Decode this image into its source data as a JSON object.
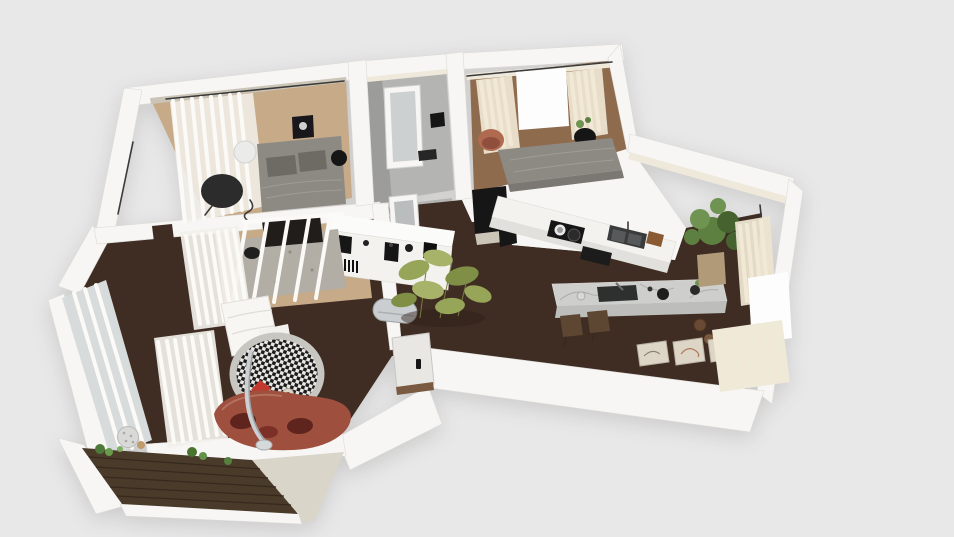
{
  "meta": {
    "description": "3D rendered apartment floor plan viewed from above in perspective, interior design render on a plain light gray backdrop",
    "view": "top-down 3d dollhouse",
    "visible_text": "none"
  },
  "palette": {
    "bg": "#e8e8e9",
    "wallWhite": "#f7f6f4",
    "wallShade": "#e3e1dd",
    "wallCream": "#efe9dc",
    "wallTaupe": "#cbc5b8",
    "floorDark": "#3f2d23",
    "woodLight": "#c7aa87",
    "woodMid": "#8f6b4e",
    "floorGray": "#b4b4b2",
    "floorGrayDark": "#9c9c9a",
    "balconyWood": "#4a3a2a",
    "balconyLine": "#35291d",
    "glassGray": "#d8dbdc",
    "curtainWhite": "#fbfaf7",
    "curtainCream": "#f1e9d6",
    "curtainBaseW": "#f2f0ea",
    "curtainBaseC": "#ece4d0",
    "bedGray": "#8d8a84",
    "pillowGray": "#6e6a64",
    "sofaRust": "#9e4f3e",
    "sofaPillow": "#5e241d",
    "redPillow": "#c2392e",
    "rugBorder": "#c8c6c1",
    "rugBlack": "#1c1c1c",
    "rugWhite": "#e9e8e4",
    "areaRugGray": "#b2ada5",
    "marble": "#cecfcd",
    "marbleShade": "#bdbdbb",
    "marbleVein": "#a5a6a4",
    "counterWhite": "#f3f2ef",
    "counterShade": "#e2e0dc",
    "applianceBlack": "#161616",
    "steel": "#caced0",
    "stoolBrown": "#5d4632",
    "terracotta": "#b06a50",
    "terracottaDark": "#8f4f3c",
    "woodAccent": "#8a5a33",
    "artPaper": "#ddd6c6",
    "mirrorGlass": "#ccd0d0",
    "doorWhite": "#e9e7e3",
    "thresholdBrown": "#7a5a40",
    "greigeTop": "#d9d5c9",
    "plantGreen": "#5d7f3f",
    "plantGreenDark": "#46632f",
    "plantGreenLight": "#6f9350",
    "bambooGreen": "#96a558",
    "bambooLight": "#a8b36a",
    "bambooDark": "#7f8f45",
    "potTan": "#b09a78",
    "potBrown": "#6b4a33",
    "pureWhite": "#fdfdfd",
    "charcoal": "#2c2c2c",
    "quiltWhite": "#f7f6f3",
    "darkLine": "#3a3a3a"
  },
  "scene": {
    "rooms": [
      {
        "id": "bedroom-1",
        "label": "Bedroom 1",
        "floor": "light oak"
      },
      {
        "id": "dressing-room",
        "label": "Dressing room",
        "floor": "gray"
      },
      {
        "id": "bedroom-2",
        "label": "Bedroom 2",
        "floor": "medium wood"
      },
      {
        "id": "bathroom",
        "label": "Bathroom",
        "floor": "dark (open doorway)"
      },
      {
        "id": "hallway",
        "label": "Hallway",
        "floor": "dark walnut"
      },
      {
        "id": "kitchen-dining",
        "label": "Kitchen / dining",
        "floor": "dark walnut"
      },
      {
        "id": "living-room",
        "label": "Living room",
        "floor": "dark walnut"
      },
      {
        "id": "balcony",
        "label": "Balcony",
        "floor": "dark decking"
      }
    ],
    "furniture": [
      {
        "id": "single-bed",
        "label": "Gray bed",
        "room": "bedroom-1"
      },
      {
        "id": "round-chair-dark",
        "label": "Dark round chair",
        "room": "bedroom-1"
      },
      {
        "id": "drum-side-table",
        "label": "White drum side table",
        "room": "bedroom-1"
      },
      {
        "id": "black-stool",
        "label": "Black stool",
        "room": "bedroom-1"
      },
      {
        "id": "wall-art-moon",
        "label": "Dark framed moon art",
        "room": "bedroom-1"
      },
      {
        "id": "window-curtain",
        "label": "White sheer curtain",
        "room": "bedroom-1"
      },
      {
        "id": "standing-mirror",
        "label": "White standing mirror",
        "room": "dressing-room"
      },
      {
        "id": "standing-mirror-2",
        "label": "Second standing mirror",
        "room": "dressing-room"
      },
      {
        "id": "double-bed",
        "label": "Gray double bed",
        "room": "bedroom-2"
      },
      {
        "id": "terracotta-armchair",
        "label": "Terracotta armchair",
        "room": "bedroom-2"
      },
      {
        "id": "black-chair-plant",
        "label": "Black chair with plant",
        "room": "bedroom-2"
      },
      {
        "id": "cream-curtains",
        "label": "Cream curtains",
        "room": "bedroom-2"
      },
      {
        "id": "kitchen-counter",
        "label": "White wall counter",
        "room": "kitchen-dining"
      },
      {
        "id": "cooktop",
        "label": "Black cooktop with pots",
        "room": "kitchen-dining"
      },
      {
        "id": "kitchen-sink",
        "label": "Double sink",
        "room": "kitchen-dining"
      },
      {
        "id": "cutting-board",
        "label": "Cutting board",
        "room": "kitchen-dining"
      },
      {
        "id": "fridge",
        "label": "Dark fridge column",
        "room": "kitchen-dining"
      },
      {
        "id": "kitchen-island",
        "label": "Marble kitchen island",
        "room": "kitchen-dining"
      },
      {
        "id": "bar-stools",
        "label": "Two wooden bar stools",
        "room": "kitchen-dining"
      },
      {
        "id": "large-plant",
        "label": "Large potted plant",
        "room": "kitchen-dining"
      },
      {
        "id": "floor-pots",
        "label": "Clay floor pots",
        "room": "kitchen-dining"
      },
      {
        "id": "art-frames",
        "label": "Three leaning art frames",
        "room": "kitchen-dining"
      },
      {
        "id": "sideboard",
        "label": "White sideboard with black decor",
        "room": "hallway"
      },
      {
        "id": "bamboo-plant",
        "label": "Bamboo plant",
        "room": "hallway"
      },
      {
        "id": "radiator",
        "label": "Chrome radiator bench",
        "room": "hallway"
      },
      {
        "id": "entrance-door",
        "label": "Entrance door",
        "room": "hallway"
      },
      {
        "id": "glass-partition",
        "label": "Glass slat partition",
        "room": "living-room"
      },
      {
        "id": "dining-bench",
        "label": "Dark dining bench",
        "room": "living-room"
      },
      {
        "id": "area-rug-gray",
        "label": "Gray area rug",
        "room": "living-room"
      },
      {
        "id": "round-rug",
        "label": "Round houndstooth rug",
        "room": "living-room"
      },
      {
        "id": "red-floor-pillow",
        "label": "Red diamond floor pillow",
        "room": "living-room"
      },
      {
        "id": "curved-sofa",
        "label": "Curved rust sofa",
        "room": "living-room"
      },
      {
        "id": "arc-lamp",
        "label": "Chrome arc floor lamp",
        "room": "living-room"
      },
      {
        "id": "white-quilt",
        "label": "White quilt / daybed",
        "room": "living-room"
      },
      {
        "id": "sphere-side-table",
        "label": "Speckled sphere side table",
        "room": "living-room"
      },
      {
        "id": "balcony-plants",
        "label": "Green balcony plants",
        "room": "balcony"
      }
    ]
  }
}
